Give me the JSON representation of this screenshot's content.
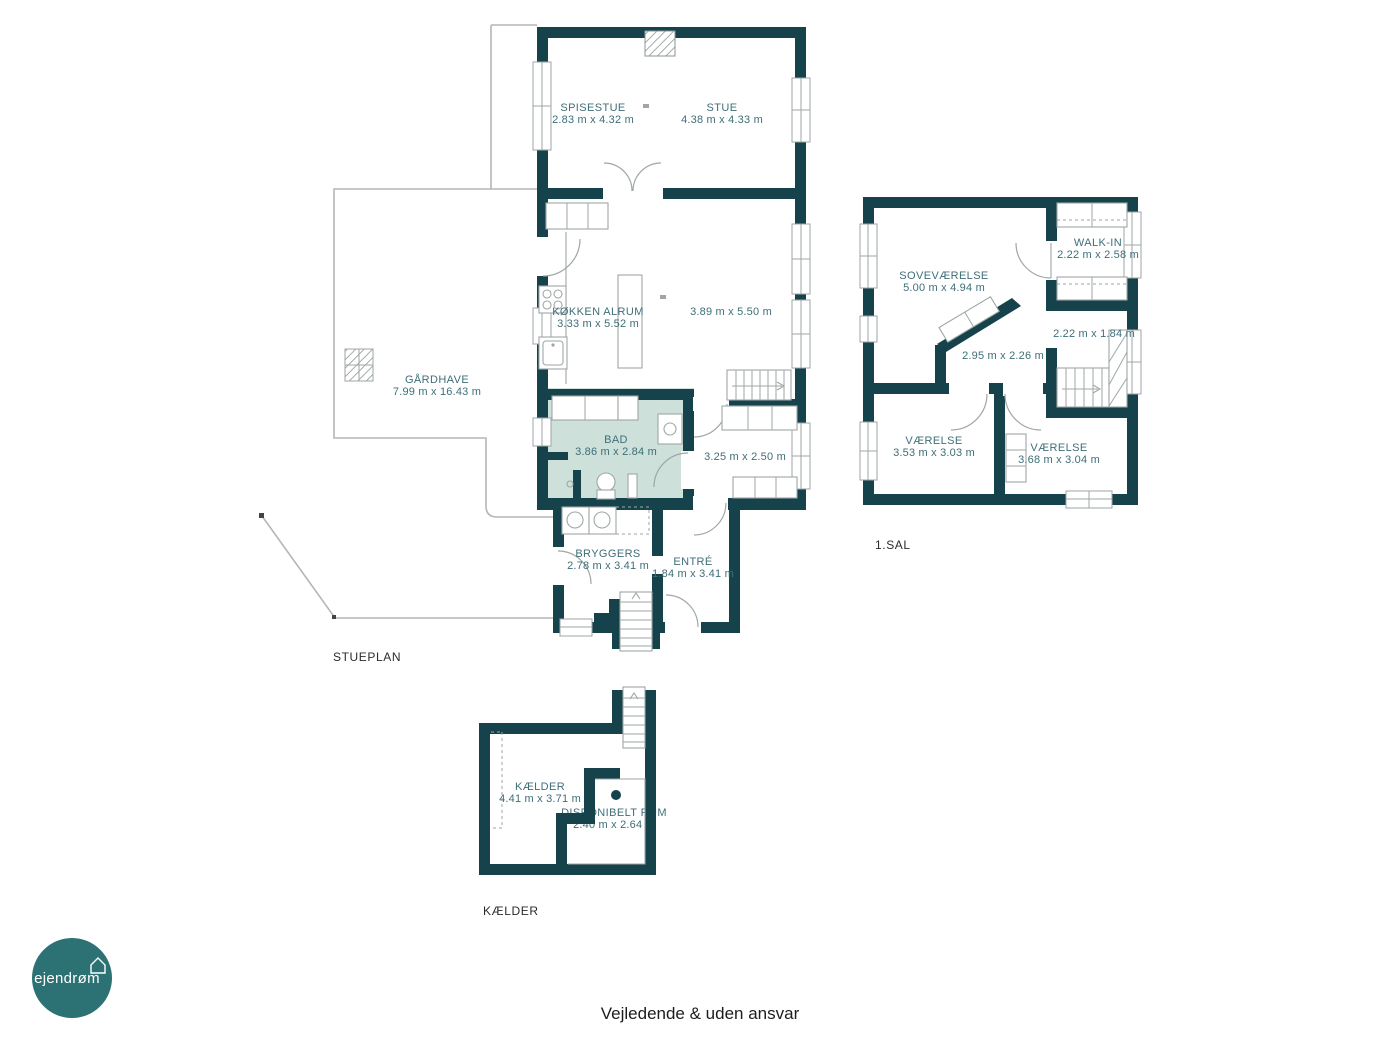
{
  "page": {
    "footer_disclaimer": "Vejledende & uden ansvar",
    "background": "#ffffff"
  },
  "logo": {
    "text": "ejendrøm",
    "icon": "house-icon",
    "circle_color": "#2c7173",
    "text_color": "#ffffff"
  },
  "palette": {
    "wall": "#16434b",
    "room_label": "#3e6e78",
    "bathroom_highlight": "#cde0d9",
    "furniture_line": "#9fa6a6",
    "boundary_line": "#b6b6b6",
    "floor_title": "#2b2b2b"
  },
  "floors": [
    {
      "title": "STUEPLAN",
      "rooms": [
        {
          "name": "SPISESTUE",
          "dims": "2.83 m x 4.32 m"
        },
        {
          "name": "STUE",
          "dims": "4.38 m x 4.33 m"
        },
        {
          "name": "KØKKEN ALRUM",
          "dims": "3.33 m x 5.52 m"
        },
        {
          "name": "",
          "dims": "3.89 m x 5.50 m"
        },
        {
          "name": "BAD",
          "dims": "3.86 m x 2.84 m",
          "highlighted": true
        },
        {
          "name": "",
          "dims": "3.25 m x 2.50 m"
        },
        {
          "name": "BRYGGERS",
          "dims": "2.78 m x 3.41 m"
        },
        {
          "name": "ENTRÉ",
          "dims": "1.84 m x 3.41 m"
        },
        {
          "name": "GÅRDHAVE",
          "dims": "7.99 m x 16.43 m"
        }
      ]
    },
    {
      "title": "1.SAL",
      "rooms": [
        {
          "name": "SOVEVÆRELSE",
          "dims": "5.00 m x 4.94 m"
        },
        {
          "name": "WALK-IN",
          "dims": "2.22 m x 2.58 m"
        },
        {
          "name": "",
          "dims": "2.22 m x 1.84 m"
        },
        {
          "name": "",
          "dims": "2.95 m x 2.26 m"
        },
        {
          "name": "VÆRELSE",
          "dims": "3.53 m x 3.03 m"
        },
        {
          "name": "VÆRELSE",
          "dims": "3.68 m x 3.04 m"
        }
      ]
    },
    {
      "title": "KÆLDER",
      "rooms": [
        {
          "name": "KÆLDER",
          "dims": "4.41 m x 3.71 m"
        },
        {
          "name": "DISPONIBELT RUM",
          "dims": "2.40 m x 2.64 m"
        }
      ]
    }
  ]
}
